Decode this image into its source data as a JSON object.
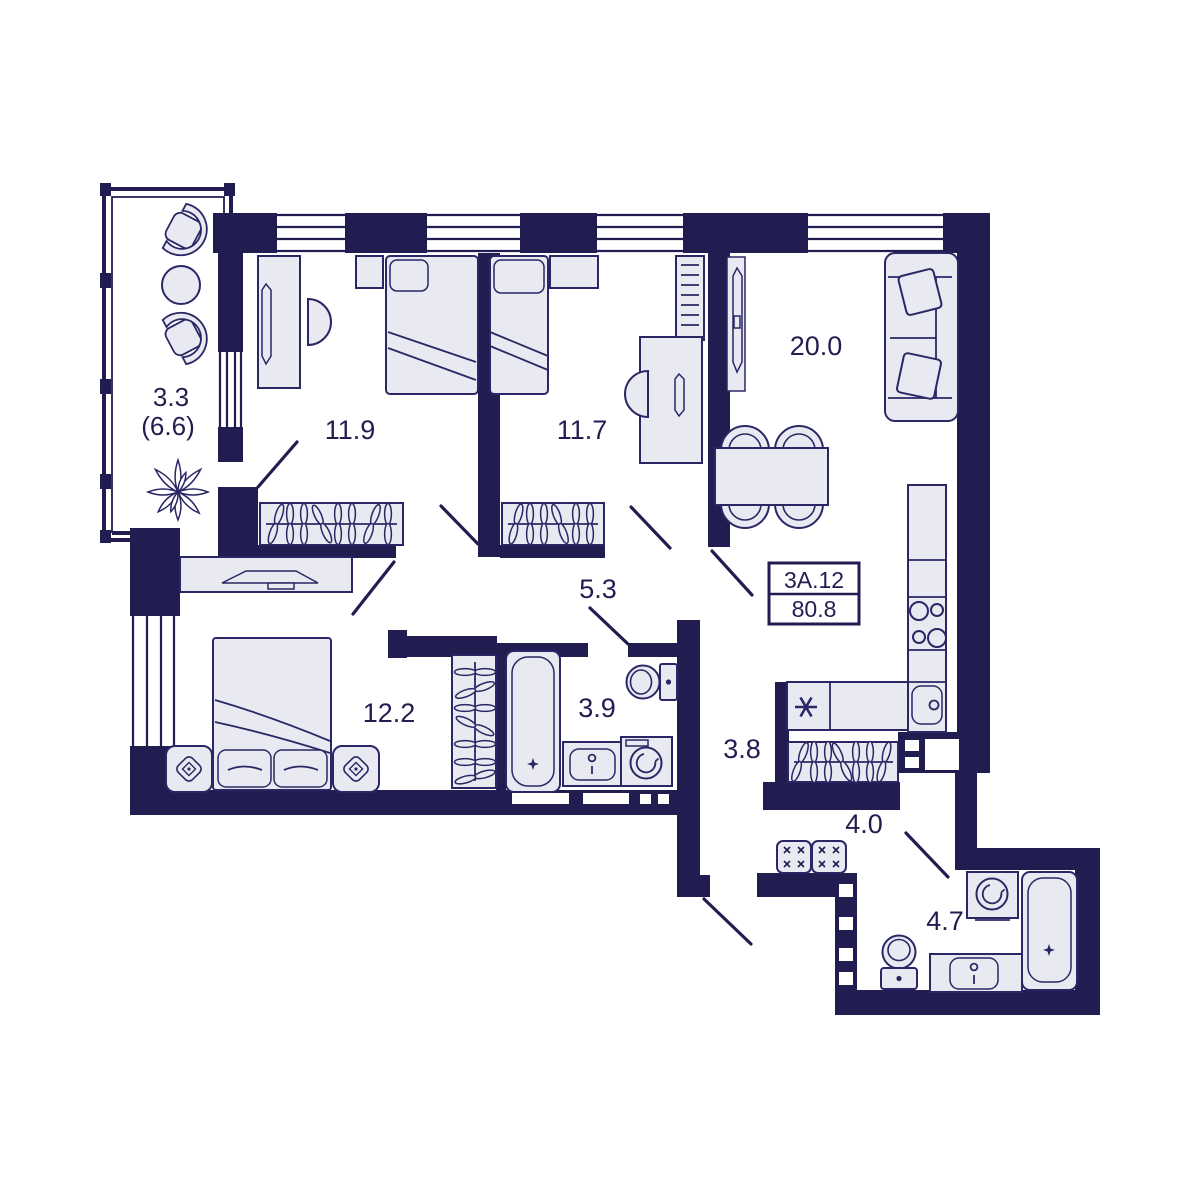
{
  "plan": {
    "apartment": {
      "number": "3А.12",
      "total_area": "80.8"
    },
    "rooms": {
      "balcony": {
        "label": "3.3",
        "label_secondary": "(6.6)"
      },
      "bedroom_1": {
        "label": "11.9"
      },
      "bedroom_2": {
        "label": "11.7"
      },
      "living_kitchen": {
        "label": "20.0"
      },
      "hallway": {
        "label": "5.3"
      },
      "bedroom_3": {
        "label": "12.2"
      },
      "bathroom_1": {
        "label": "3.9"
      },
      "corridor": {
        "label": "3.8"
      },
      "entry": {
        "label": "4.0"
      },
      "bathroom_2": {
        "label": "4.7"
      }
    },
    "colors": {
      "wall": "#221d51",
      "furniture_fill": "#e9e9f1",
      "outline": "#2b2766",
      "text": "#221d51",
      "background": "#ffffff"
    }
  }
}
